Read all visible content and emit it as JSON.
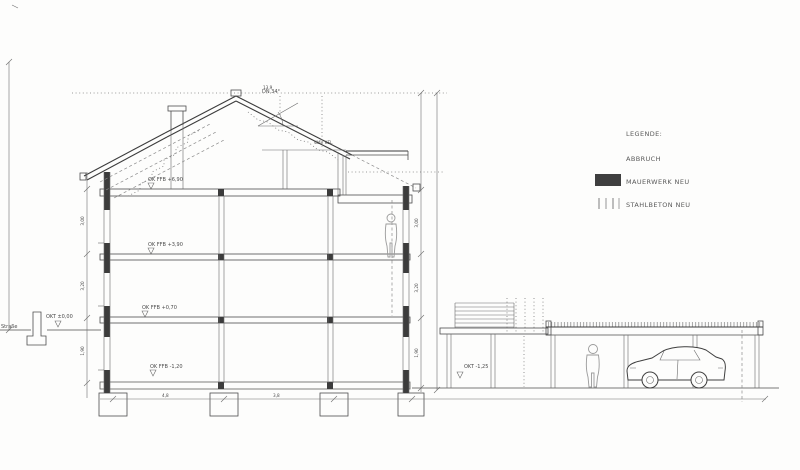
{
  "legend": {
    "title": "LEGENDE:",
    "items": [
      {
        "label": "ABBRUCH"
      },
      {
        "label": "MAUERWERK NEU",
        "swatch": "#3f3f3f"
      },
      {
        "label": "STAHLBETON NEU",
        "swatch": "hatched"
      }
    ]
  },
  "levels": {
    "attic": "OK FFB +6,90",
    "upper": "OK FFB +3,90",
    "ground": "OK FFB +0,70",
    "basement": "OK FFB -1,20"
  },
  "site": {
    "street_label": "Straße",
    "street_level": "OKT ±0,00",
    "yard_level": "OKT -1,25"
  },
  "roof": {
    "pitch": "DN 34°",
    "attic_note": "WAV KEL",
    "ridge_height": "13,9"
  },
  "dims": {
    "storey_upper": "3,00",
    "storey_mid": "3,20",
    "storey_lower": "1,90",
    "bay_left": "4,8",
    "bay_right": "3,8"
  }
}
